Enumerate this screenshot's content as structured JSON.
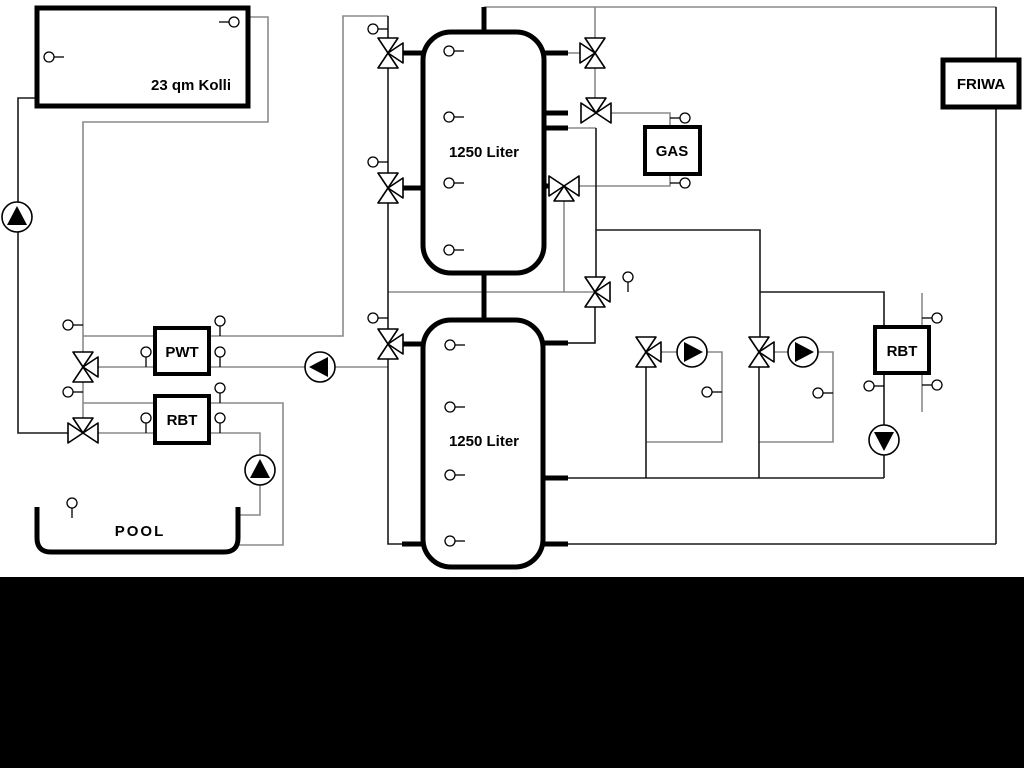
{
  "diagram_type": "heating-solar-pool hydraulic schematic",
  "labels": {
    "collector": "23 qm Kolli",
    "tank_upper": "1250 Liter",
    "tank_lower": "1250 Liter",
    "gas": "GAS",
    "friwa": "FRIWA",
    "pwt": "PWT",
    "rbt_left": "RBT",
    "rbt_right": "RBT",
    "pool": "POOL"
  },
  "colors": {
    "background": "#ffffff",
    "footer_band": "#000000",
    "line_gray": "#8a8a8a",
    "line_dark": "#1a1a1a",
    "component_stroke": "#000000",
    "pump_fill": "#000000"
  },
  "symbols": {
    "pumps": [
      {
        "id": "solar-pump",
        "direction": "up"
      },
      {
        "id": "pwt-pump",
        "direction": "left"
      },
      {
        "id": "pool-pump",
        "direction": "up"
      },
      {
        "id": "heating-pump-1",
        "direction": "right"
      },
      {
        "id": "heating-pump-2",
        "direction": "right"
      },
      {
        "id": "rbt-right-pump",
        "direction": "down"
      }
    ],
    "three_way_valves": 11,
    "temperature_sensors": 30
  }
}
